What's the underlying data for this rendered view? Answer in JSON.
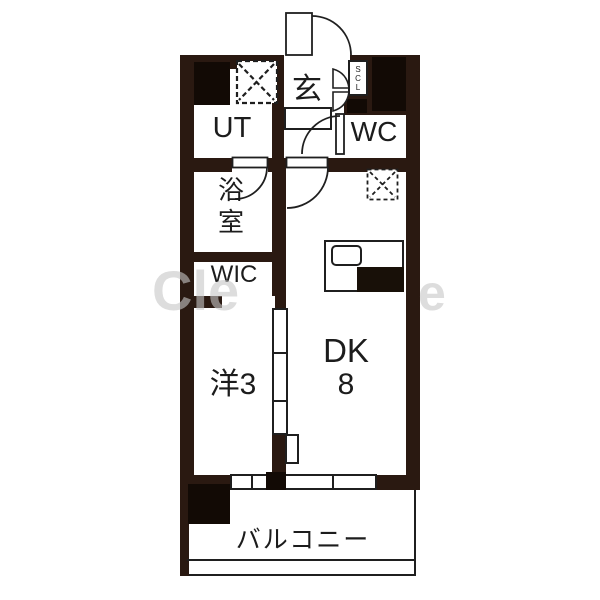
{
  "title": "apartment-floor-plan",
  "colors": {
    "wall": "#2a1911",
    "solid_block": "#120a05",
    "line": "#1f1f1f",
    "floor": "#ffffff",
    "watermark": "#c7c7c7"
  },
  "rooms": {
    "entrance": {
      "label": "玄"
    },
    "shoe_closet": {
      "label": "SCL"
    },
    "utility": {
      "label": "UT"
    },
    "toilet": {
      "label": "WC"
    },
    "bathroom": {
      "label": "浴室"
    },
    "walk_in_closet": {
      "label": "WIC"
    },
    "western_room": {
      "label": "洋3"
    },
    "dining_kitchen": {
      "label": "DK",
      "size": "8"
    },
    "balcony": {
      "label": "バルコニー"
    }
  },
  "fixtures": {
    "washing_machine_space": "dashed-x-box",
    "refrigerator_space": "dashed-x-box",
    "kitchen_counter": "counter-with-sink",
    "entrance_door": "outward-swing-door",
    "wc_door": "swing-door",
    "bath_door": "swing-door",
    "dk_door": "swing-door",
    "shoe_closet_door": "bifold-door",
    "room_partition": "three-panel-sliding-door"
  },
  "watermark": {
    "left": "Cle",
    "right": "e"
  }
}
